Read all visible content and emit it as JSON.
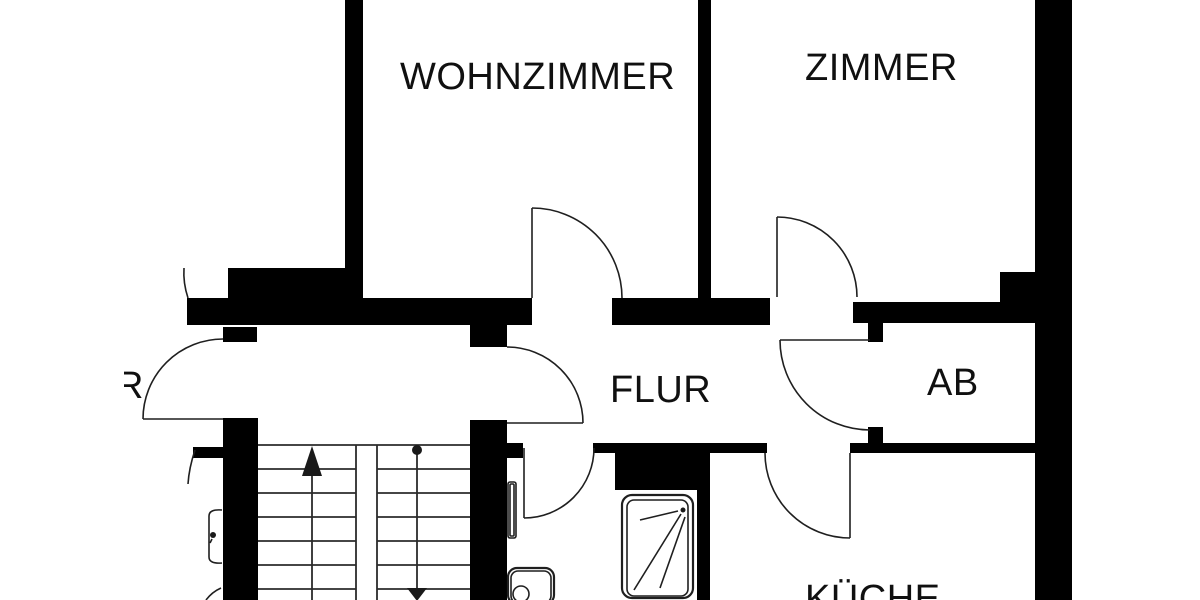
{
  "document": {
    "kind": "architectural floor plan (Grundriss)",
    "background": "#ffffff"
  },
  "colors": {
    "wall": "#000000",
    "line": "#1f1f1f",
    "text": "#101010"
  },
  "rooms": {
    "wohnzimmer": "WOHNZIMMER",
    "zimmer": "ZIMMER",
    "flur": "FLUR",
    "ab": "AB",
    "kueche": "KÜCHE",
    "cut_label_fragment": "R"
  },
  "floorplan": {
    "walls": [
      {
        "name": "wall-wohnzimmer-left",
        "x": 345,
        "y": 0,
        "w": 18,
        "h": 300
      },
      {
        "name": "wall-upper-band-left",
        "x": 228,
        "y": 268,
        "w": 135,
        "h": 30
      },
      {
        "name": "wall-flur-top-left",
        "x": 187,
        "y": 298,
        "w": 345,
        "h": 27
      },
      {
        "name": "wall-flur-top-mid",
        "x": 612,
        "y": 298,
        "w": 158,
        "h": 27
      },
      {
        "name": "wall-wohnzimmer-zimmer-divider",
        "x": 698,
        "y": 0,
        "w": 13,
        "h": 300
      },
      {
        "name": "wall-ab-top",
        "x": 853,
        "y": 302,
        "w": 184,
        "h": 21
      },
      {
        "name": "wall-ne-chunk",
        "x": 1000,
        "y": 272,
        "w": 37,
        "h": 30
      },
      {
        "name": "wall-right-outer",
        "x": 1035,
        "y": 0,
        "w": 37,
        "h": 600
      },
      {
        "name": "wall-ab-door-stub-top",
        "x": 868,
        "y": 323,
        "w": 15,
        "h": 19
      },
      {
        "name": "wall-ab-door-stub-bottom",
        "x": 868,
        "y": 427,
        "w": 15,
        "h": 16
      },
      {
        "name": "wall-mid-band-right",
        "x": 850,
        "y": 443,
        "w": 187,
        "h": 10
      },
      {
        "name": "wall-mid-band-center",
        "x": 593,
        "y": 443,
        "w": 174,
        "h": 10
      },
      {
        "name": "wall-shaft-above-shower",
        "x": 615,
        "y": 453,
        "w": 82,
        "h": 37
      },
      {
        "name": "wall-bath-kueche-divider",
        "x": 697,
        "y": 453,
        "w": 13,
        "h": 147
      },
      {
        "name": "wall-mid-band-left-stub",
        "x": 505,
        "y": 443,
        "w": 18,
        "h": 15
      },
      {
        "name": "wall-stair-right",
        "x": 470,
        "y": 420,
        "w": 37,
        "h": 180
      },
      {
        "name": "wall-stair-right-stub-top",
        "x": 470,
        "y": 325,
        "w": 37,
        "h": 22
      },
      {
        "name": "wall-stair-left",
        "x": 223,
        "y": 418,
        "w": 35,
        "h": 182
      },
      {
        "name": "wall-entrance-stub",
        "x": 223,
        "y": 327,
        "w": 34,
        "h": 15
      },
      {
        "name": "wall-left-stub",
        "x": 193,
        "y": 447,
        "w": 30,
        "h": 11
      }
    ],
    "doors": [
      {
        "name": "door-wohnzimmer",
        "arc": "M532 208A90 90 0 0 1 622 298",
        "leaf": [
          532,
          208,
          532,
          298
        ]
      },
      {
        "name": "door-zimmer",
        "arc": "M777 217A80 80 0 0 1 857 297",
        "leaf": [
          777,
          217,
          777,
          297
        ]
      },
      {
        "name": "door-entrance",
        "arc": "M223 339A80 80 0 0 0 143 419",
        "leaf": [
          143,
          419,
          223,
          419
        ]
      },
      {
        "name": "door-corridor-flur",
        "arc": "M507 347A76 76 0 0 1 583 423",
        "leaf": [
          507,
          423,
          583,
          423
        ]
      },
      {
        "name": "door-bathroom",
        "arc": "M594 448A70 70 0 0 1 524 518",
        "leaf": [
          524,
          448,
          524,
          518
        ]
      },
      {
        "name": "door-kueche",
        "arc": "M765 453A85 85 0 0 0 850 538",
        "leaf": [
          850,
          453,
          850,
          538
        ]
      },
      {
        "name": "door-ab",
        "arc": "M780 340A90 90 0 0 0 870 430",
        "leaf": [
          780,
          340,
          870,
          340
        ]
      }
    ],
    "fragments": [
      {
        "name": "arc-fragment-top-left",
        "d": "M188 298Q183 283 184 268"
      },
      {
        "name": "arc-fragment-left",
        "d": "M195 450Q189 468 188 484"
      },
      {
        "name": "arc-fragment-bottom-left",
        "d": "M206 600Q212 592 221 588"
      }
    ],
    "stairs": {
      "lines": [
        [
          258,
          445,
          470,
          445
        ],
        [
          258,
          469,
          356,
          469
        ],
        [
          258,
          493,
          356,
          493
        ],
        [
          258,
          517,
          356,
          517
        ],
        [
          258,
          541,
          356,
          541
        ],
        [
          258,
          565,
          356,
          565
        ],
        [
          258,
          589,
          356,
          589
        ],
        [
          377,
          469,
          470,
          469
        ],
        [
          377,
          493,
          470,
          493
        ],
        [
          377,
          517,
          470,
          517
        ],
        [
          377,
          541,
          470,
          541
        ],
        [
          377,
          565,
          470,
          565
        ],
        [
          377,
          589,
          470,
          589
        ],
        [
          356,
          445,
          356,
          600
        ],
        [
          377,
          445,
          377,
          600
        ],
        [
          312,
          450,
          312,
          600
        ],
        [
          417,
          452,
          417,
          590
        ]
      ],
      "arrowheads": [
        {
          "name": "stair-arrow-up",
          "pts": "312,446 302,476 322,476"
        },
        {
          "name": "stair-arrow-down",
          "pts": "417,601 407,588 427,588"
        }
      ],
      "start_dot": [
        417,
        450,
        5
      ]
    },
    "fixtures": [
      {
        "name": "shower-tray-outer",
        "t": "rect",
        "x": 622,
        "y": 495,
        "w": 71,
        "h": 103,
        "rx": 10,
        "cls": "ln2"
      },
      {
        "name": "shower-tray-inner",
        "t": "rect",
        "x": 627,
        "y": 500,
        "w": 61,
        "h": 96,
        "rx": 7,
        "cls": "ln"
      },
      {
        "name": "shower-drain-dot",
        "t": "circle",
        "cx": 683,
        "cy": 510,
        "r": 2.5,
        "cls": "fillb"
      },
      {
        "name": "shower-spray-line",
        "t": "line",
        "p": [
          640,
          520,
          678,
          511
        ],
        "cls": "ln"
      },
      {
        "name": "shower-spray-line",
        "t": "line",
        "p": [
          634,
          590,
          681,
          514
        ],
        "cls": "ln"
      },
      {
        "name": "shower-spray-line",
        "t": "line",
        "p": [
          660,
          588,
          685,
          517
        ],
        "cls": "ln"
      },
      {
        "name": "toilet-outer",
        "t": "rect",
        "x": 508,
        "y": 568,
        "w": 46,
        "h": 36,
        "rx": 9,
        "cls": "ln2"
      },
      {
        "name": "toilet-inner",
        "t": "rect",
        "x": 511,
        "y": 571,
        "w": 40,
        "h": 32,
        "rx": 7,
        "cls": "ln"
      },
      {
        "name": "toilet-bowl",
        "t": "circle",
        "cx": 521,
        "cy": 594,
        "r": 8,
        "cls": "ln"
      },
      {
        "name": "radiator-outer",
        "t": "rect",
        "x": 508,
        "y": 482,
        "w": 8,
        "h": 56,
        "rx": 2,
        "cls": "ln"
      },
      {
        "name": "radiator-inner",
        "t": "rect",
        "x": 510,
        "y": 484,
        "w": 4,
        "h": 52,
        "rx": 1,
        "cls": "ln"
      },
      {
        "name": "sink-bracket",
        "t": "path",
        "d": "M222 510Q209 509 209 516L209 557Q209 564 222 563",
        "cls": "ln"
      },
      {
        "name": "bracket-detail-dot",
        "t": "circle",
        "cx": 213,
        "cy": 535,
        "r": 3,
        "cls": "fillb"
      },
      {
        "name": "bracket-detail-tail",
        "t": "line",
        "p": [
          212,
          539,
          210,
          543
        ],
        "cls": "ln"
      }
    ],
    "texts": [
      {
        "name": "room-label-wohnzimmer",
        "x": 400,
        "y": 89,
        "bind": "rooms.wohnzimmer"
      },
      {
        "name": "room-label-zimmer",
        "x": 805,
        "y": 80,
        "bind": "rooms.zimmer"
      },
      {
        "name": "room-label-flur",
        "x": 610,
        "y": 402,
        "bind": "rooms.flur"
      },
      {
        "name": "room-label-ab",
        "x": 927,
        "y": 395,
        "bind": "rooms.ab"
      },
      {
        "name": "room-label-kueche",
        "x": 805,
        "y": 611,
        "bind": "rooms.kueche"
      },
      {
        "name": "room-label-fragment-r",
        "x": 116,
        "y": 398,
        "bind": "rooms.cut_label_fragment",
        "clip": [
          124,
          358,
          30,
          46
        ]
      }
    ]
  }
}
